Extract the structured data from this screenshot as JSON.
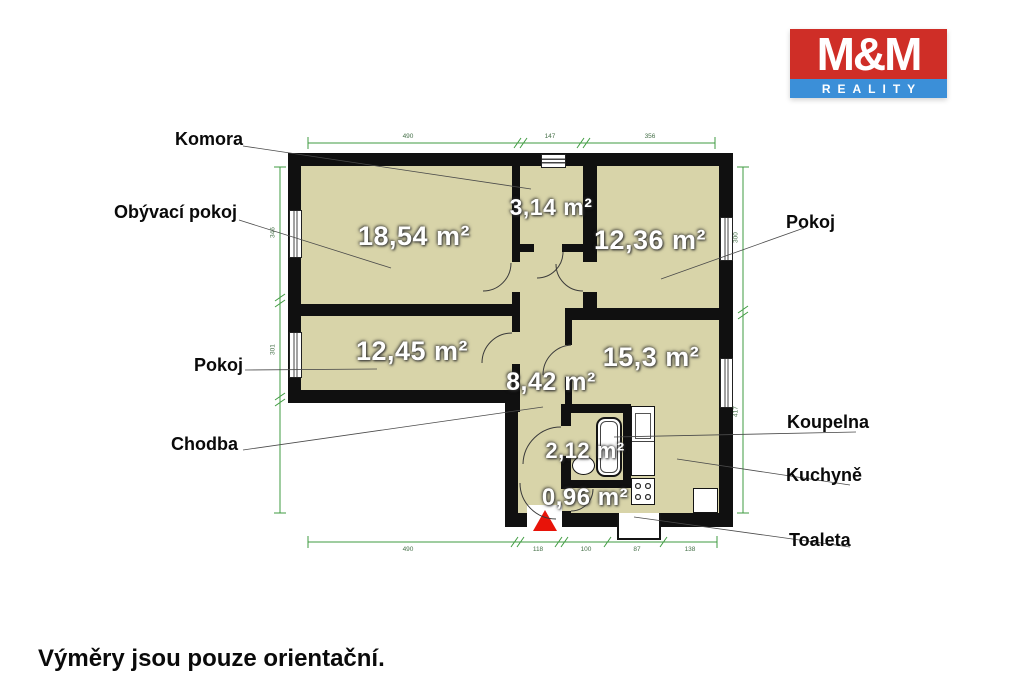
{
  "brand": {
    "name": "M&M",
    "tagline": "REALITY",
    "red": "#cf2e27",
    "blue": "#3b8fd8"
  },
  "footer": {
    "note": "Výměry jsou pouze orientační."
  },
  "rooms": {
    "obyvaci": {
      "label": "Obývací pokoj",
      "area": "18,54 m²"
    },
    "komora": {
      "label": "Komora",
      "area": "3,14 m²"
    },
    "pokoj_right": {
      "label": "Pokoj",
      "area": "12,36 m²"
    },
    "pokoj_left": {
      "label": "Pokoj",
      "area": "12,45 m²"
    },
    "kuchyne": {
      "label": "Kuchyně",
      "area": "15,3 m²"
    },
    "chodba": {
      "label": "Chodba",
      "area": "8,42 m²"
    },
    "koupelna": {
      "label": "Koupelna",
      "area": "2,12 m²"
    },
    "toaleta": {
      "label": "Toaleta",
      "area": "0,96 m²"
    }
  },
  "dimensions": {
    "top": [
      "490",
      "147",
      "356"
    ],
    "bottom": [
      "490",
      "118",
      "100",
      "87",
      "138"
    ],
    "left": [
      "346",
      "301"
    ],
    "right": [
      "300",
      "417"
    ]
  },
  "colors": {
    "wall": "#101010",
    "room_fill": "#d8d4a9",
    "dimension_line": "#3f9b40",
    "entrance_marker": "#e81309"
  }
}
